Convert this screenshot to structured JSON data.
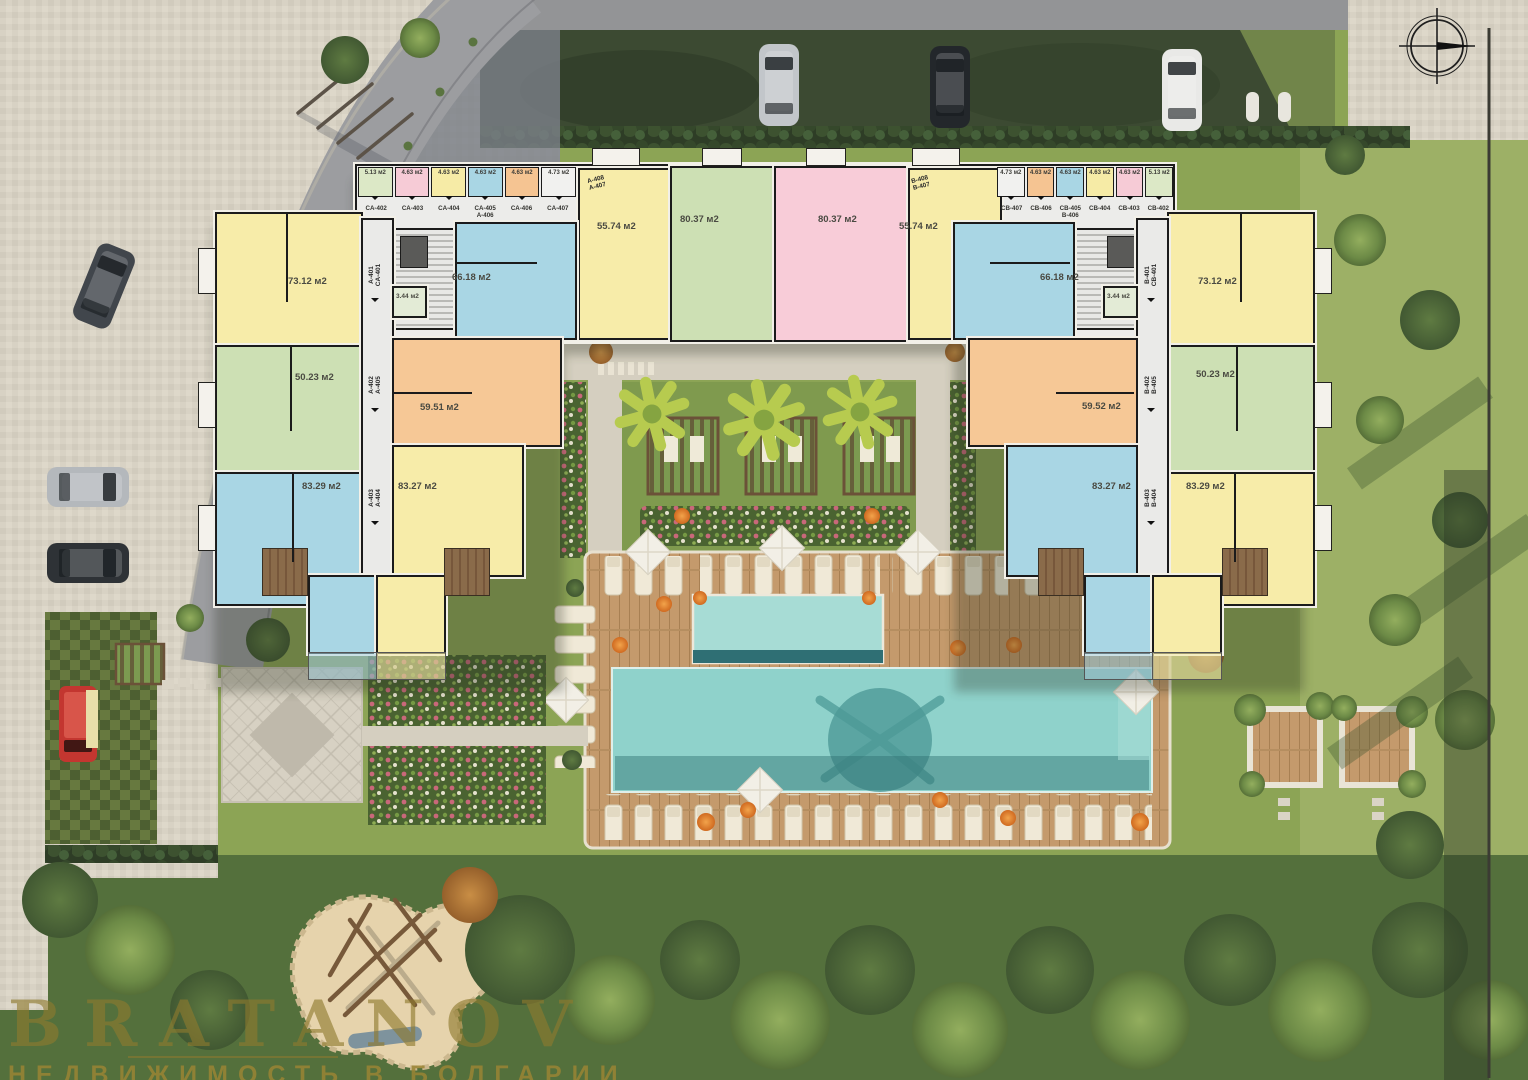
{
  "watermark": {
    "brand": "BRATANOV",
    "tagline": "НЕДВИЖИМОСТЬ В БОЛГАРИИ"
  },
  "icons": {
    "compass": "north-arrow"
  },
  "palette": {
    "grass": "#8CA455",
    "grassLight": "#9DB066",
    "forest": "#54703C",
    "pavement": "#D8D2C4",
    "road": "#939496",
    "pool": "#8FD2CB",
    "poolUpper": "#A7DCD5",
    "deckWood": "#C49A6C",
    "wall": "#1B1B1B",
    "accentOrange": "#E07B2A",
    "unitYellow": "#F7ECA9",
    "unitGreen": "#CDE0B4",
    "unitBlue": "#A9D6E4",
    "unitOrange": "#F6C896",
    "unitPink": "#F8CCD8",
    "corridor": "#EAEAE8",
    "watermarkGold": "#8F7A2E"
  },
  "plan": {
    "left": {
      "u73": "73.12 м2",
      "u50": "50.23 м2",
      "u83a": "83.29 м2",
      "u59": "59.51 м2",
      "u83b": "83.27 м2",
      "u66": "66.18 м2",
      "u344": "3.44 м2",
      "u55": "55.74 м2",
      "u80": "80.37 м2",
      "corr": [
        {
          "a": "A-401",
          "b": "CA-401"
        },
        {
          "a": "A-402",
          "b": "A-405"
        },
        {
          "a": "A-403",
          "b": "A-404"
        }
      ],
      "entry": {
        "a": "A-408",
        "b": "A-407"
      },
      "storage": {
        "cells": [
          "5.13 м2",
          "4.63 м2",
          "4.63 м2",
          "4.63 м2",
          "4.63 м2",
          "4.73 м2"
        ],
        "labels": [
          "CA-402",
          "CA-403",
          "CA-404",
          "CA-405",
          "CA-406",
          "CA-407"
        ],
        "sub": "A-406"
      }
    },
    "right": {
      "u73": "73.12 м2",
      "u50": "50.23 м2",
      "u83a": "83.29 м2",
      "u59": "59.52 м2",
      "u83b": "83.27 м2",
      "u66": "66.18 м2",
      "u344": "3.44 м2",
      "u55": "55.74 м2",
      "u80": "80.37 м2",
      "corr": [
        {
          "a": "B-401",
          "b": "CB-401"
        },
        {
          "a": "B-402",
          "b": "B-405"
        },
        {
          "a": "B-403",
          "b": "B-404"
        }
      ],
      "entry": {
        "a": "B-408",
        "b": "B-407"
      },
      "storage": {
        "cells": [
          "4.73 м2",
          "4.63 м2",
          "4.63 м2",
          "4.63 м2",
          "4.63 м2",
          "5.13 м2"
        ],
        "labels": [
          "CB-407",
          "CB-406",
          "CB-405",
          "CB-404",
          "CB-403",
          "CB-402"
        ],
        "sub": "B-406"
      }
    }
  }
}
